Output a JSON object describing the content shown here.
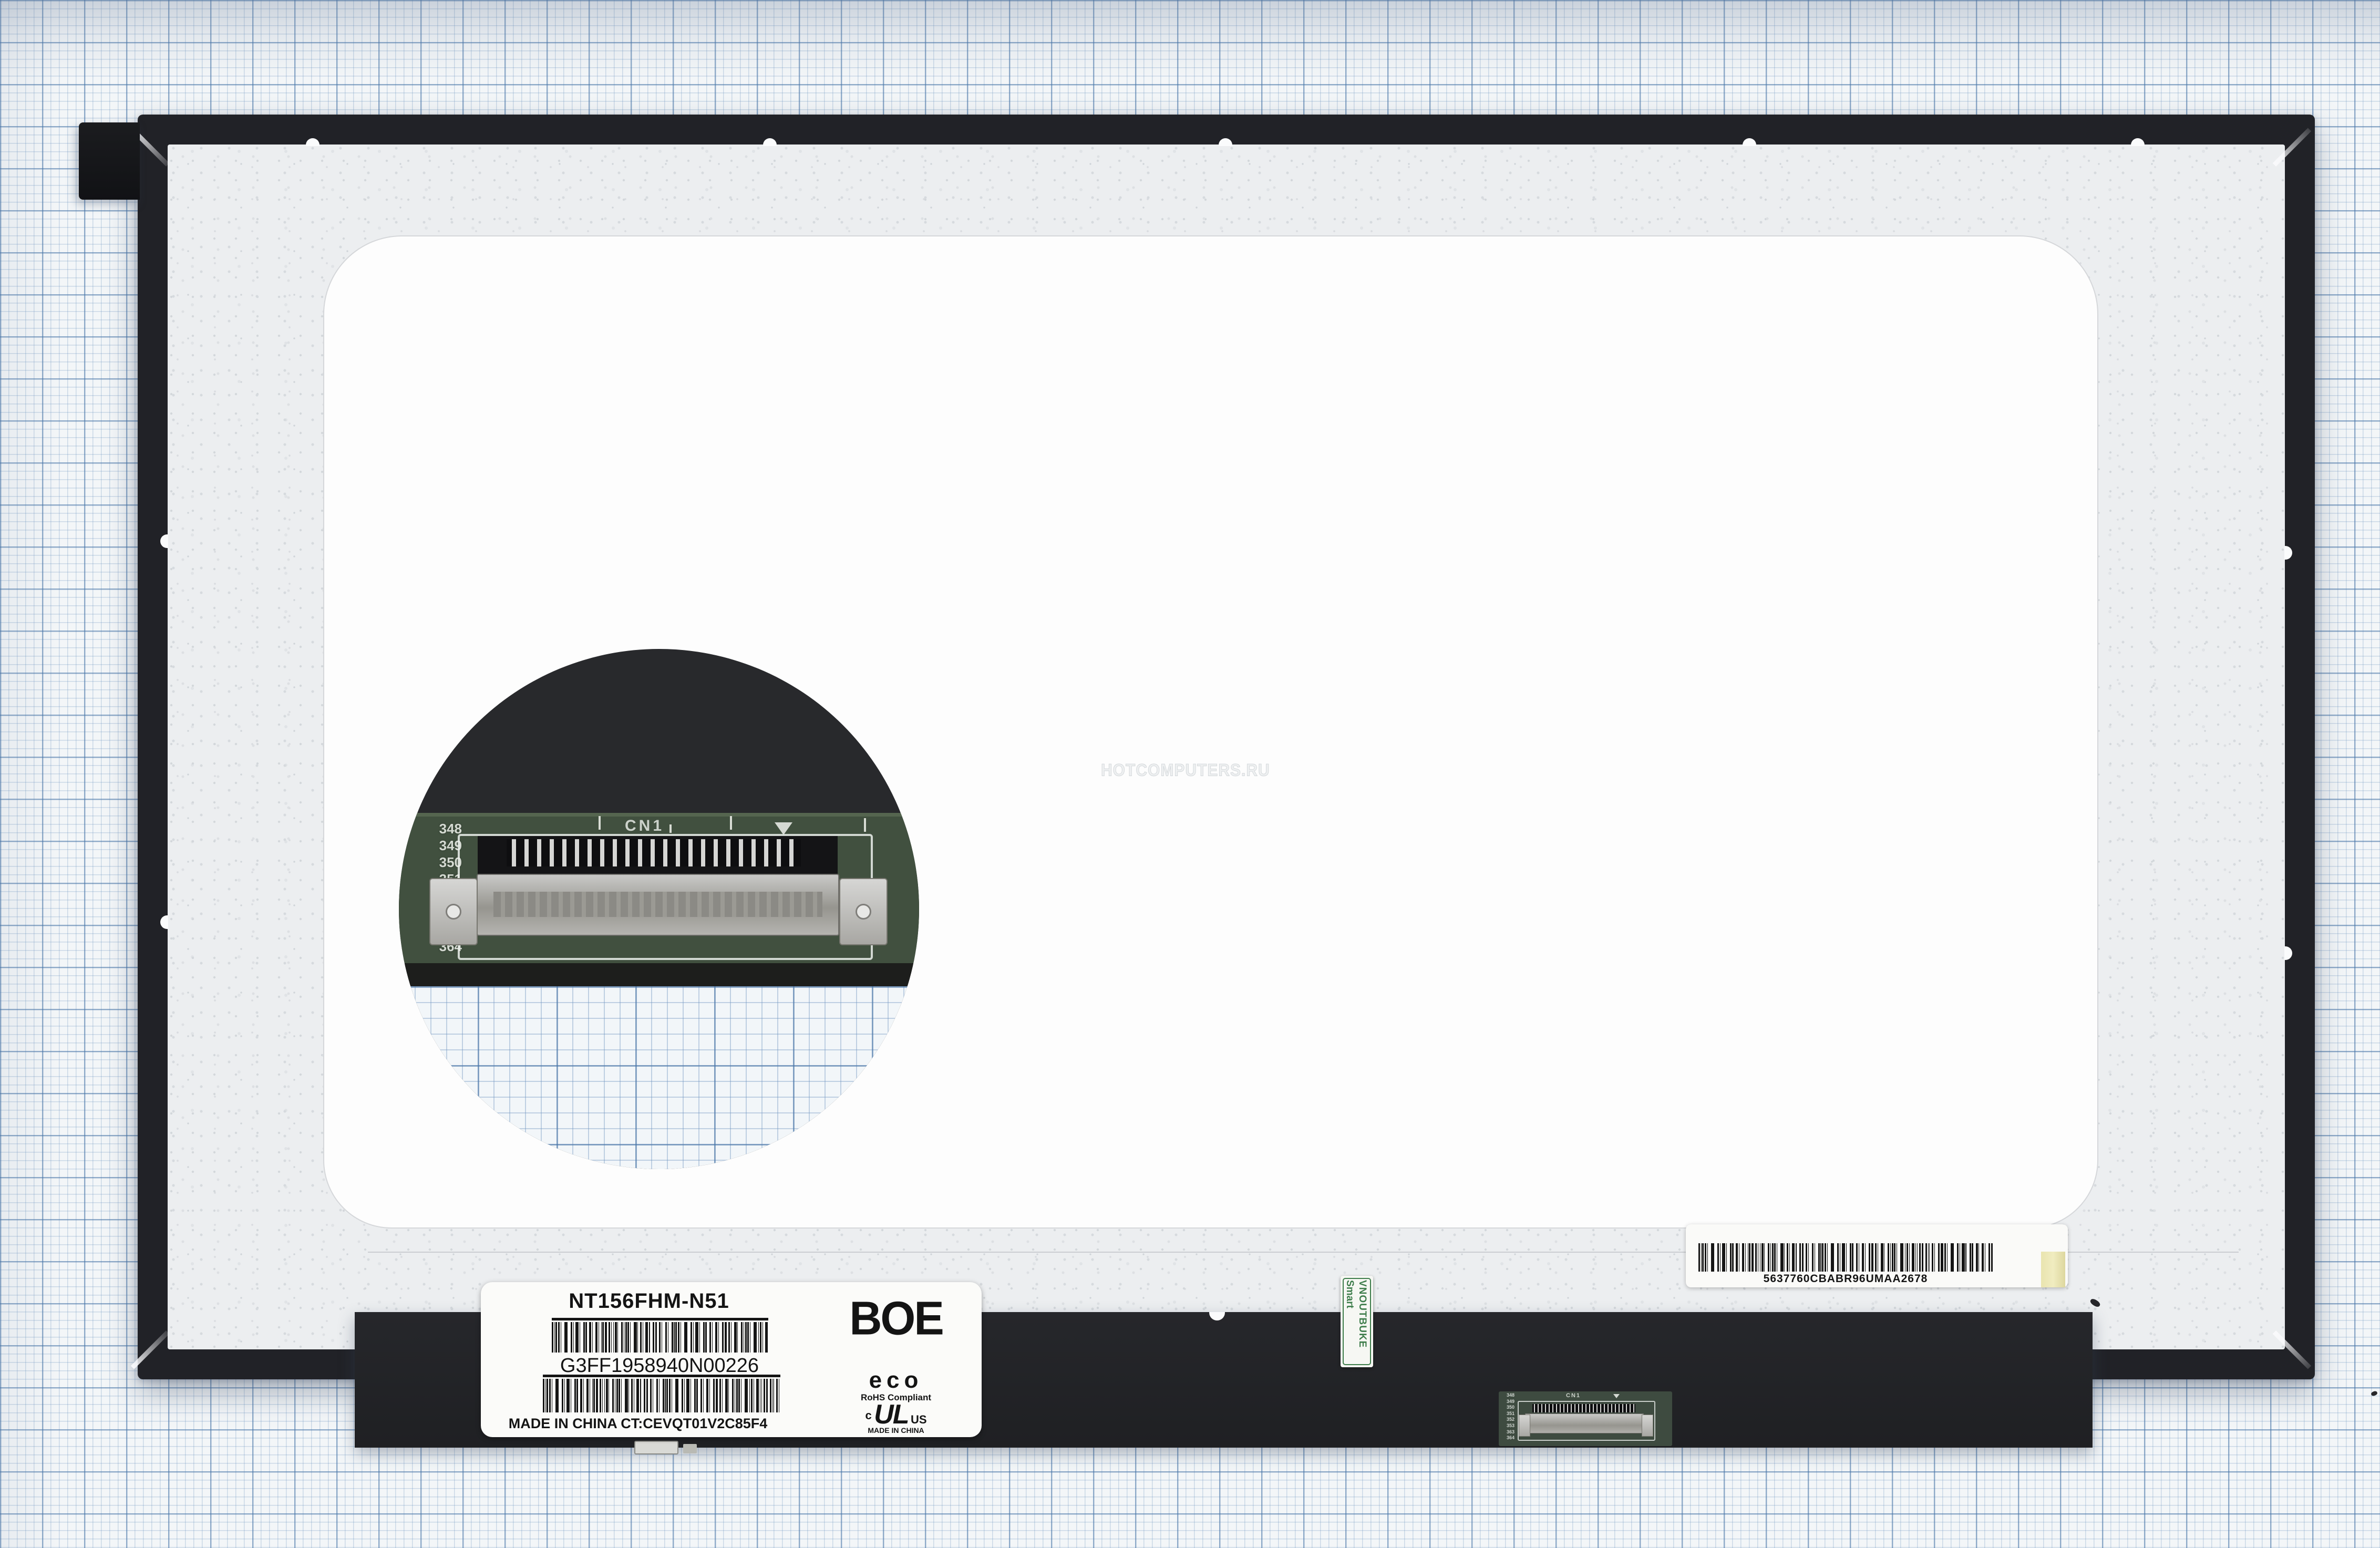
{
  "watermark": "HOTCOMPUTERS.RU",
  "label": {
    "model": "NT156FHM-N51",
    "serial": "G3FF1958940N00226",
    "origin_line": "MADE IN CHINA CT:CEVQT01V2C85F4",
    "brand": "BOE",
    "eco": "eco",
    "rohs": "RoHS Compliant",
    "ul_left": "c",
    "ul_mark": "UL",
    "ul_right": "US",
    "ul_origin": "MADE IN CHINA"
  },
  "reseller_sticker": {
    "line1": "Smart",
    "line2": "VNOUTBUKE"
  },
  "serial_strip": {
    "code": "5637760CBABR96UMAA2678"
  },
  "connector": {
    "designator": "CN1",
    "pins": [
      "348",
      "349",
      "350",
      "351",
      "352",
      "353",
      "363",
      "364"
    ]
  },
  "colors": {
    "paper_grid_blue": "#6f9ac0",
    "panel_frame_black": "#212227",
    "film_gray": "#eceef0",
    "pcb_green": "#41503f",
    "sticker_green": "#3e7d4b",
    "barcode_tab_yellow": "#e9e4af",
    "label_white": "#fbfbf9"
  }
}
